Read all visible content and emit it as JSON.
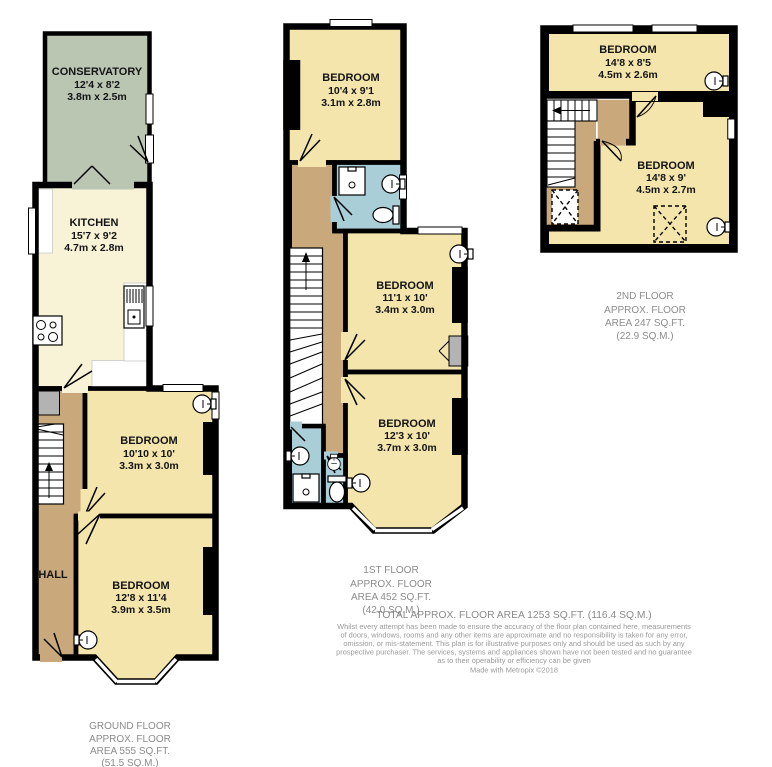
{
  "floors": {
    "ground": {
      "caption": [
        "GROUND FLOOR",
        "APPROX. FLOOR",
        "AREA 555 SQ.FT.",
        "(51.5 SQ.M.)"
      ],
      "rooms": {
        "conservatory": {
          "name": "CONSERVATORY",
          "dims_ft": "12'4 x 8'2",
          "dims_m": "3.8m x 2.5m"
        },
        "kitchen": {
          "name": "KITCHEN",
          "dims_ft": "15'7 x 9'2",
          "dims_m": "4.7m x 2.8m"
        },
        "bedroom_rear": {
          "name": "BEDROOM",
          "dims_ft": "10'10 x 10'",
          "dims_m": "3.3m x 3.0m"
        },
        "bedroom_front": {
          "name": "BEDROOM",
          "dims_ft": "12'8 x 11'4",
          "dims_m": "3.9m x 3.5m"
        },
        "hall": {
          "name": "HALL"
        }
      }
    },
    "first": {
      "caption": [
        "1ST FLOOR",
        "APPROX. FLOOR",
        "AREA 452 SQ.FT.",
        "(42.0 SQ.M.)"
      ],
      "rooms": {
        "bedroom_top": {
          "name": "BEDROOM",
          "dims_ft": "10'4 x 9'1",
          "dims_m": "3.1m x 2.8m"
        },
        "bedroom_mid": {
          "name": "BEDROOM",
          "dims_ft": "11'1 x 10'",
          "dims_m": "3.4m x 3.0m"
        },
        "bedroom_bottom": {
          "name": "BEDROOM",
          "dims_ft": "12'3 x 10'",
          "dims_m": "3.7m x 3.0m"
        }
      }
    },
    "second": {
      "caption": [
        "2ND FLOOR",
        "APPROX. FLOOR",
        "AREA 247 SQ.FT.",
        "(22.9 SQ.M.)"
      ],
      "rooms": {
        "bedroom_top": {
          "name": "BEDROOM",
          "dims_ft": "14'8 x 8'5",
          "dims_m": "4.5m x 2.6m"
        },
        "bedroom_bottom": {
          "name": "BEDROOM",
          "dims_ft": "14'8 x 9'",
          "dims_m": "4.5m x 2.7m"
        }
      }
    }
  },
  "footer": {
    "total": "TOTAL APPROX. FLOOR AREA 1253 SQ.FT. (116.4 SQ.M.)",
    "disclaimer": [
      "Whilst every attempt has been made to ensure the accuracy of the floor plan contained here, measurements",
      "of doors, windows, rooms and any other items are approximate and no responsibility is taken for any error,",
      "omission, or mis-statement. This plan is for illustrative purposes only and should be used as such by any",
      "prospective purchaser. The services, systems and appliances shown have not been tested and no guarantee",
      "as to their operability or efficiency can be given"
    ],
    "credit": "Made with Metropix ©2018"
  },
  "colors": {
    "room_cream": "#f3e5ac",
    "kitchen_cream": "#f8f2d6",
    "conservatory_green": "#bac5b2",
    "hall_tan": "#c9a87c",
    "bathroom_blue": "#a9ced8",
    "storage_gray": "#b3b3b3",
    "wall": "#000000",
    "caption_text": "#8c8c8c"
  },
  "icons": [
    "sink-icon",
    "toilet-icon",
    "shower-icon",
    "stove-icon",
    "appliance-icon",
    "stairs-icon",
    "skylight-dashed-box",
    "window",
    "door-leaf"
  ]
}
